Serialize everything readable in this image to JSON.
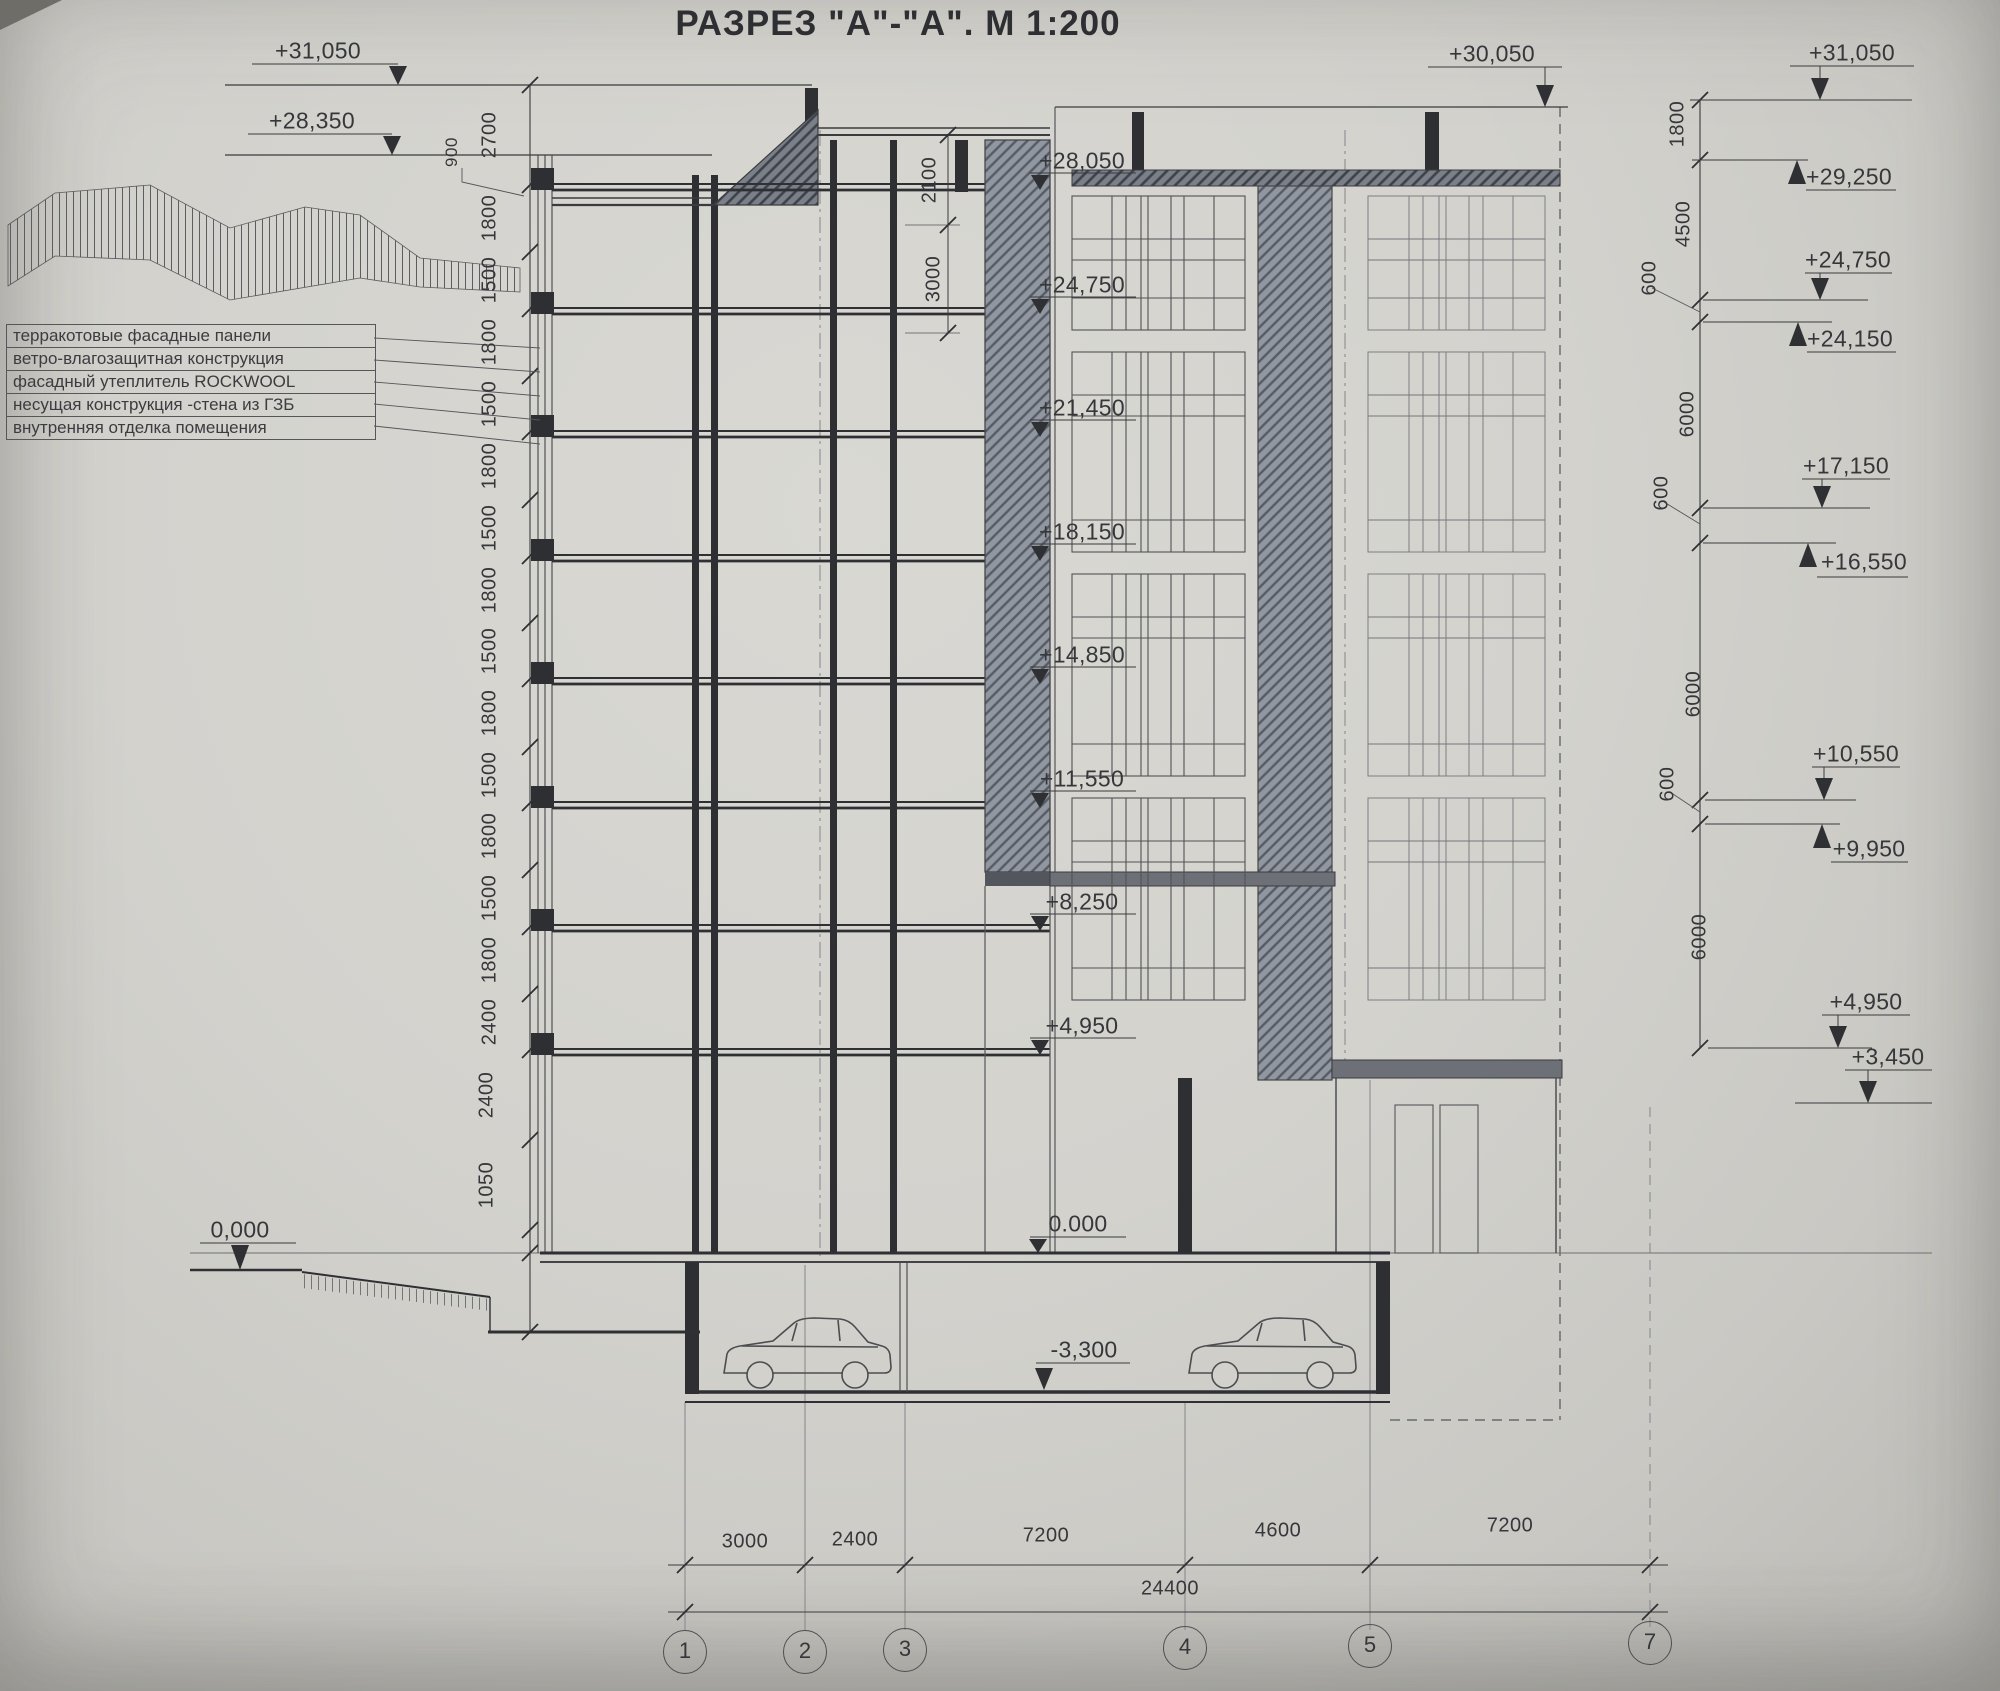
{
  "colors": {
    "paper": "#d2d1cc",
    "ink": "#35363a"
  },
  "title": "РАЗРЕЗ \"А\"-\"А\". М 1:200",
  "legend": {
    "items": [
      "терракотовые фасадные панели",
      "ветро-влагозащитная конструкция",
      "фасадный утеплитель  ROCKWOOL",
      "несущая конструкция -стена из ГЗБ",
      "внутренняя отделка помещения"
    ]
  },
  "left": {
    "elevations": [
      "+31,050",
      "+28,350",
      "0,000"
    ],
    "chain": [
      "900",
      "2700",
      "1800",
      "1500",
      "1800",
      "1500",
      "1800",
      "1500",
      "1800",
      "1500",
      "1800",
      "1500",
      "1800",
      "1500",
      "1800",
      "2400",
      "2400",
      "1050"
    ]
  },
  "section": {
    "elevations": [
      "+28,050",
      "+24,750",
      "+21,450",
      "+18,150",
      "+14,850",
      "+11,550",
      "+8,250",
      "+4,950",
      "0.000",
      "-3,300"
    ],
    "roof_dims": [
      "2100",
      "3000"
    ],
    "facade_top": "+30,050"
  },
  "right": {
    "levels": [
      "+31,050",
      "+29,250",
      "+24,750",
      "+24,150",
      "+17,150",
      "+16,550",
      "+10,550",
      "+9,950",
      "+4,950",
      "+3,450"
    ],
    "chain": [
      "1800",
      "4500",
      "600",
      "6000",
      "600",
      "6000",
      "600",
      "6000"
    ]
  },
  "bottom": {
    "dims": [
      "3000",
      "2400",
      "7200",
      "4600",
      "7200"
    ],
    "total": "24400",
    "grid": [
      "1",
      "2",
      "3",
      "4",
      "5",
      "7"
    ]
  }
}
